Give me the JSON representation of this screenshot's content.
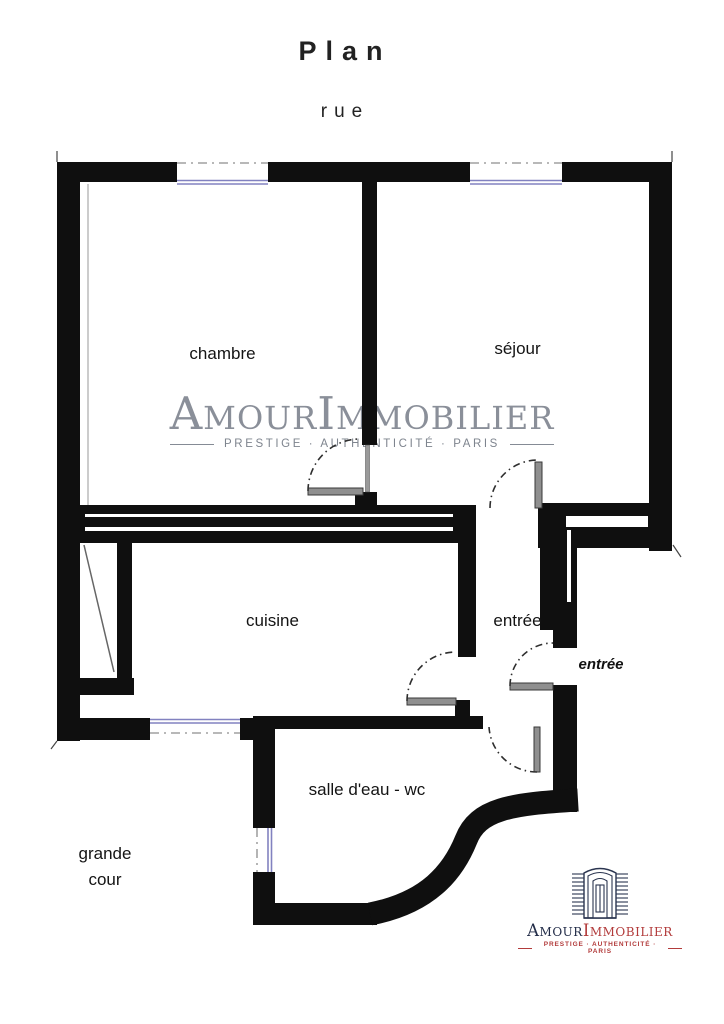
{
  "page": {
    "title": "Plan",
    "street": "rue"
  },
  "rooms": [
    {
      "id": "chambre",
      "label": "chambre"
    },
    {
      "id": "sejour",
      "label": "séjour"
    },
    {
      "id": "cuisine",
      "label": "cuisine"
    },
    {
      "id": "entree",
      "label": "entrée"
    },
    {
      "id": "salle-deau-wc",
      "label": "salle d'eau - wc"
    },
    {
      "id": "grande-cour",
      "label": "grande cour"
    }
  ],
  "entrance_arrow_label": "entrée",
  "watermark": {
    "brand": "AmourImmobilier",
    "tagline": "PRESTIGE · AUTHENTICITÉ · PARIS"
  },
  "logo": {
    "brand_amour": "Amour",
    "brand_immobilier": "Immobilier",
    "tagline": "PRESTIGE · AUTHENTICITÉ · PARIS"
  },
  "colors": {
    "wall": "#0f0f0f",
    "window": "#8282c0",
    "door_leaf": "#8f8f8f",
    "watermark_gray": "#8a8f99",
    "logo_navy": "#2b3550",
    "logo_red": "#b23b3b"
  }
}
